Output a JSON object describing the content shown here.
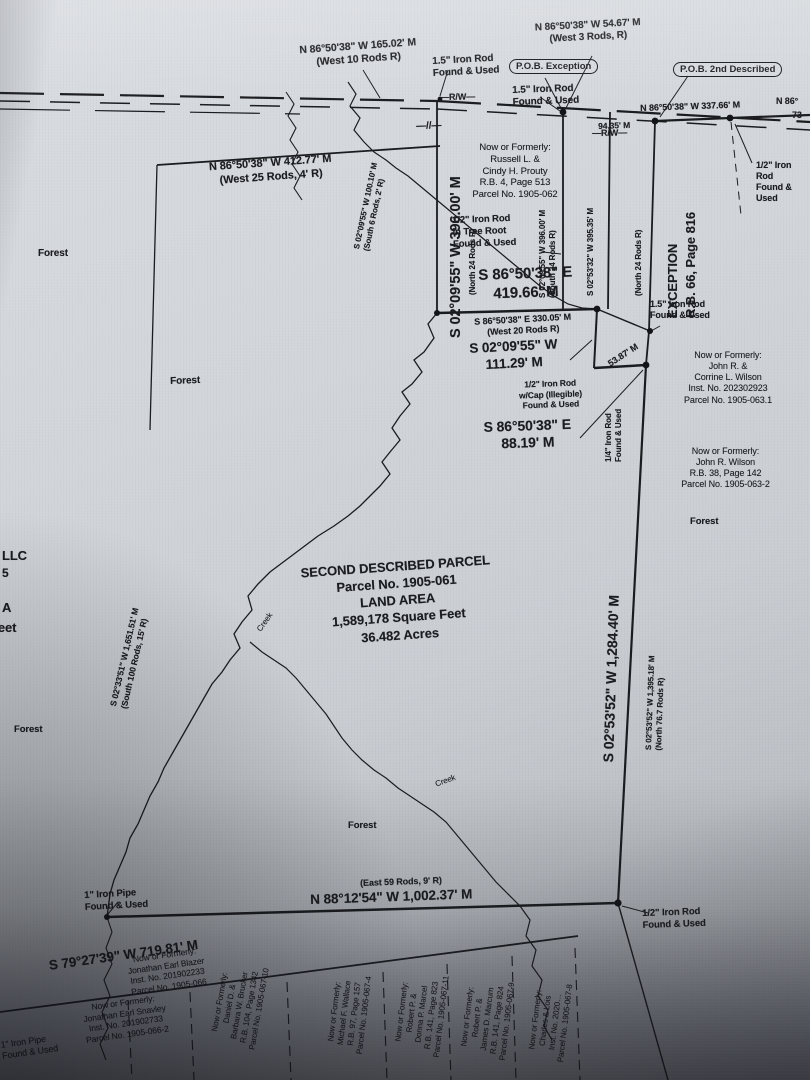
{
  "document": {
    "type": "survey-plat-photo",
    "ink_color": "#1b1c1f",
    "paper_color": "#d2d6da"
  },
  "parcel_summary": {
    "text": "SECOND DESCRIBED PARCEL\nParcel No. 1905-061\nLAND AREA\n1,589,178 Square Feet\n36.482 Acres"
  },
  "pob": {
    "exception": "P.O.B. Exception",
    "second_described": "P.O.B. 2nd Described"
  },
  "exception_block": {
    "title": "EXCEPTION\nR.B. 66, Page 816",
    "record_note": "(North 24 Rods R)"
  },
  "bearings": {
    "b16502": "N 86°50'38\" W 165.02' M\n(West 10 Rods R)",
    "b5467": "N 86°50'38\" W 54.67' M\n(West 3 Rods, R)",
    "b33766": "N 86°50'38\" W 337.66' M",
    "b9435": "94.35' M",
    "b41277": "N 86°50'38\" W 412.77' M\n(West 25 Rods, 4' R)",
    "b39600_big": "S 02°09'55\" W 396.00' M",
    "b39600_note": "(North 24 Rods R)",
    "b39600_east": "S 02°09'55\" W 396.00' M\n(South 24 Rods R)",
    "b39535": "S 02°53'32\" W 395.35' M",
    "b10010": "S 02°09'55\" W 100.10' M\n(South 6 Rods, 2' R)",
    "b41966": "S 86°50'38\" E\n419.66' M",
    "b33005": "S 86°50'38\" E 330.05' M\n(West 20 Rods R)",
    "b11129": "S 02°09'55\" W\n111.29' M",
    "b5387": "53.87' M",
    "b8819": "S 86°50'38\" E\n88.19' M",
    "b128440": "S 02°53'52\" W 1,284.40' M",
    "b139518": "S 02°53'52\" W 1,395.18' M\n(North 76.7 Rods R)",
    "b165151": "S 02°33'51\" W 1,651.51' M\n(South 100 Rods, 15' R)",
    "b_east59": "(East 59 Rods, 9' R)",
    "b100237": "N 88°12'54\" W 1,002.37' M",
    "b71981": "S 79°27'39\" W 719.81' M"
  },
  "monuments": {
    "rod15_a": "1.5\" Iron Rod\nFound & Used",
    "rod15_b": "1.5\" Iron Rod\nFound & Used",
    "rod15_c": "1.5\" Iron Rod\nFound & Used",
    "rod12_tree": "1/2\" Iron Rod\nin Tree Root\nFound & Used",
    "rod12_cap": "1/2\" Iron Rod\nw/Cap (Illegible)\nFound & Used",
    "rod14": "1/4\" Iron Rod\nFound & Used",
    "rod12_edge": "1/2\" Iron Rod\nFound & Used",
    "rod12_bottom": "1/2\" Iron Rod\nFound & Used",
    "pipe1": "1\" Iron Pipe\nFound & Used",
    "pipe2": "1\" Iron Pipe\nFound & Used"
  },
  "owners": {
    "prouty": "Now or Formerly:\nRussell L. &\nCindy H. Prouty\nR.B. 4, Page 513\nParcel No. 1905-062",
    "wilson1": "Now or Formerly:\nJohn R. &\nCorrine L. Wilson\nInst. No. 202302923\nParcel No. 1905-063.1",
    "wilson2": "Now or Formerly:\nJohn R. Wilson\nR.B. 38, Page 142\nParcel No. 1905-063-2",
    "blazer": "Now or Formerly:\nJonathan Earl Blazer\nInst. No. 201902233\nParcel No. 1905-066",
    "snavley": "Now or Formerly:\nJonathan Earl Snavley\nInst. No. 201902733\nParcel No. 1905-066-2",
    "brucker": "Now or Formerly:\nDaniel D. &\nBarbara W. Brucker\nR.B. 104, Page 1342\nParcel No. 1905-067-10",
    "wallace": "Now or Formerly:\nMichael F. Wallace\nR.B. 97, Page 157\nParcel No. 1905-067-4",
    "marcel": "Now or Formerly:\nRobert P. &\nDonna P. Marcel\nR.B. 141, Page 823\nParcel No. 1905-067-11",
    "marcum": "Now or Formerly:\nRobert P. &\nJames D. Marcum\nR.B. 141, Page 824\nParcel No. 1905-067-9",
    "charles": "Now or Formerly:\nCharles & Lois\nInst. No. 2020…\nParcel No. 1905-067-8"
  },
  "features": {
    "forest": "Forest",
    "creek": "Creek",
    "rw": "—R/W—",
    "line_break": "—//—"
  },
  "edge_fragments": {
    "llc": "LLC",
    "five": "5",
    "a": "A",
    "feet": "Feet",
    "n86": "N 86°",
    "n73": "73"
  }
}
